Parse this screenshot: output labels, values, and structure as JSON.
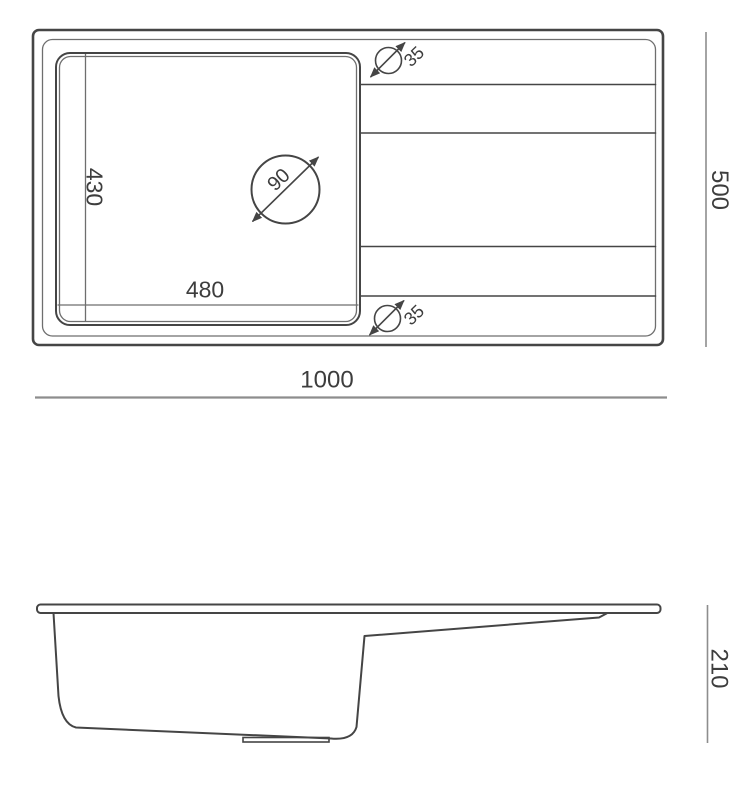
{
  "top_view": {
    "overall_width_label": "1000",
    "overall_depth_label": "500",
    "bowl_width_label": "480",
    "bowl_depth_label": "430",
    "drain_diameter_label": "90",
    "tap_hole_top_diameter_label": "35",
    "tap_hole_bottom_diameter_label": "35"
  },
  "side_view": {
    "height_label": "210"
  },
  "colors": {
    "line": "#454545",
    "thin-line": "#6e6e6e",
    "dim-line": "#8d8d8d",
    "text": "#3d3d3d",
    "background": "#ffffff"
  }
}
